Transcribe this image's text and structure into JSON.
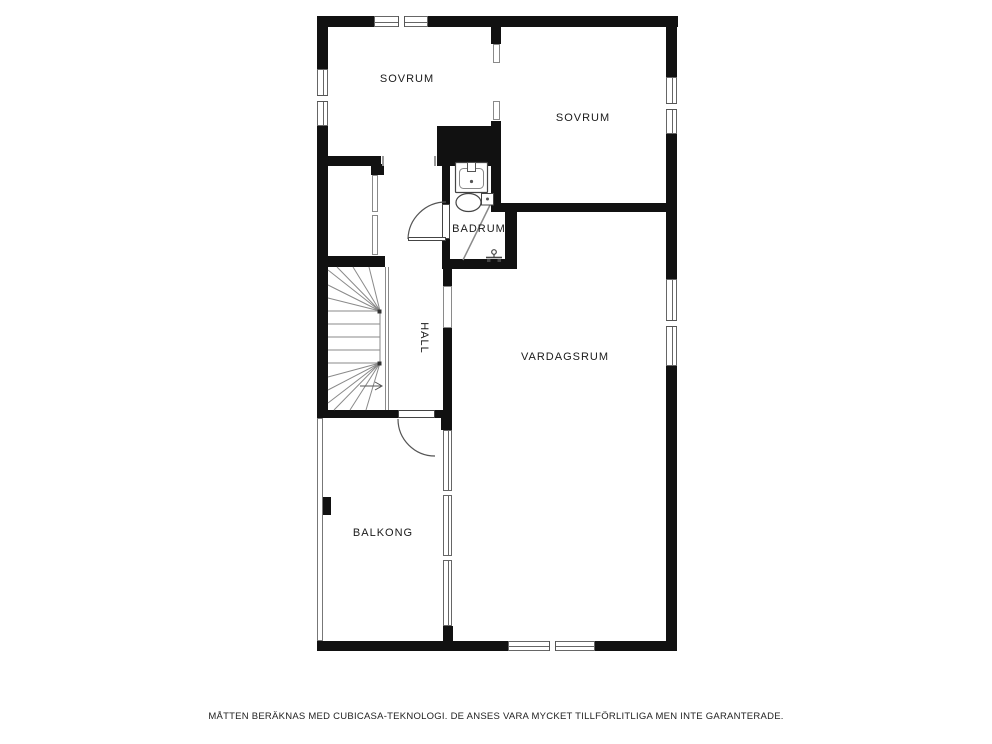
{
  "floorplan": {
    "rooms": [
      {
        "name": "sovrum-left",
        "label": "SOVRUM"
      },
      {
        "name": "sovrum-right",
        "label": "SOVRUM"
      },
      {
        "name": "badrum",
        "label": "BADRUM"
      },
      {
        "name": "hall",
        "label": "HALL"
      },
      {
        "name": "vardagsrum",
        "label": "VARDAGSRUM"
      },
      {
        "name": "balkong",
        "label": "BALKONG"
      }
    ],
    "fixtures": [
      {
        "icon": "staircase-icon"
      },
      {
        "icon": "sink-icon"
      },
      {
        "icon": "toilet-icon"
      },
      {
        "icon": "shower-faucet-icon"
      },
      {
        "icon": "door-swing-icon"
      }
    ],
    "disclaimer": "MÅTTEN BERÄKNAS MED CUBICASA-TEKNOLOGI. DE ANSES VARA MYCKET TILLFÖRLITLIGA MEN INTE GARANTERADE.",
    "colors": {
      "wall": "#111111",
      "thin_line": "#777777",
      "text": "#1a1a1a",
      "background": "#ffffff"
    }
  }
}
